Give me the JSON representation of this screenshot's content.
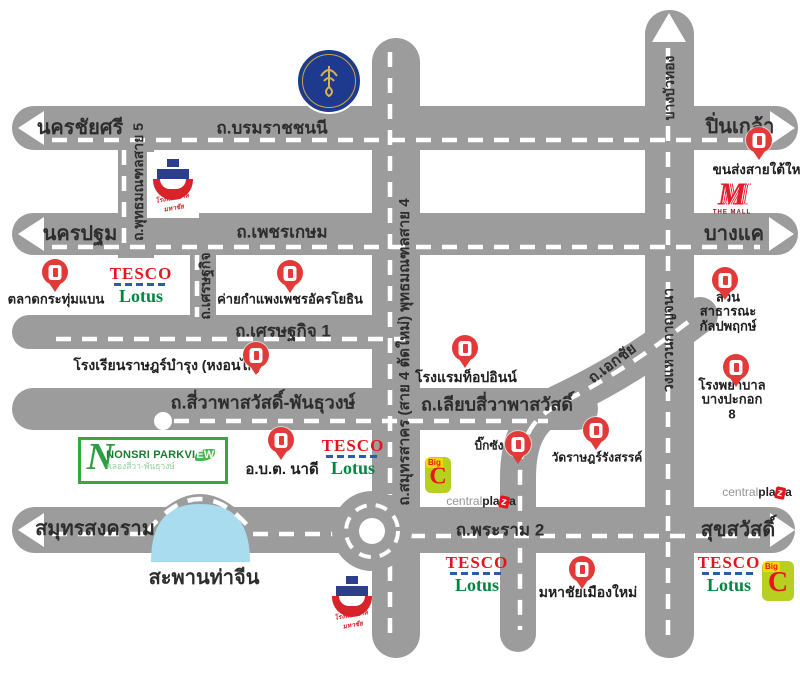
{
  "colors": {
    "road_gray": "#9c9c9c",
    "dash_white": "#ffffff",
    "water_blue": "#a9dcef",
    "pin_red": "#e23a38",
    "tesco_red": "#e8131c",
    "tesco_blue": "#2a5caa",
    "lotus_green": "#008542",
    "bigc_green": "#b8cf22",
    "nonsri_green": "#35a93c",
    "mahidol_navy": "#1d3a8f",
    "hospital_blue": "#2b3f8c",
    "hospital_red": "#d8232a"
  },
  "roads": {
    "boromratchachonnani": "ถ.บรมราชชนนี",
    "phetkasem": "ถ.เพชรเกษม",
    "setthakit1": "ถ.เศรษฐกิจ 1",
    "setthakit_v": "ถ.เศรษฐกิจ",
    "sivapha": "ถ.สี่วาพาสวัสดิ์-พันธุวงษ์",
    "liap_sivapha": "ถ.เลียบสี่วาพาสวัสดิ์",
    "rama2": "ถ.พระราม 2",
    "phutthamonthon5": "ถ.พุทธมณฑลสาย 5",
    "samutsakhon_sai4": "ถ.สมุทรสาคร (สาย 4 ตัดใหม่) พุทธมณฑลสาย 4",
    "ekkachai": "ถ.เอกชัย",
    "kanchanaphisek": "วงแหวนกาญจนา"
  },
  "destinations": {
    "nakhon_chai_si": "นครชัยศรี",
    "pin_klao": "ปิ่นเกล้า",
    "nakhon_pathom": "นครปฐม",
    "bang_khae": "บางแค",
    "samut_songkhram": "สมุทรสงคราม",
    "suk_sawat": "สุขสวัสดิ์",
    "bang_bua_thong": "บางบัวทอง"
  },
  "places": {
    "krathum_baen_market": "ตลาดกระทุ่มแบน",
    "army_camp": "ค่ายกำแพงเพชรอัครโยธิน",
    "school": "โรงเรียนราษฎร์บำรุง (หงอนไก่)",
    "top_inn_hotel": "โรงแรมท็อปอินน์",
    "kalapapruek_park": "สวนสาธารณะ\nกัลปพฤกษ์",
    "bangpakok8_hospital": "โรงพยาบาล\nบางปะกอก 8",
    "southern_bus_terminal": "ขนส่งสายใต้ใหม่",
    "nadi_sao": "อ.บ.ต. นาดี",
    "big_sang": "บิ๊กซัง",
    "wat_rat_rangsan": "วัดราษฎร์รังสรรค์",
    "mahachai_mueang_mai": "มหาชัยเมืองใหม่",
    "tha_chin_bridge": "สะพานท่าจีน"
  },
  "logos": {
    "nonsri": {
      "n": "N",
      "name_prefix": "NONSRI PARKVI",
      "name_leaf": "EW",
      "subtitle": "คลองสี่วา-พันธุวงษ์"
    },
    "tesco": {
      "top": "TESCO",
      "bottom": "Lotus"
    },
    "bigc": {
      "big": "Big",
      "c": "C"
    },
    "centralplaza": {
      "p1": "central",
      "p2": "pla",
      "z": "z",
      "p3": "a"
    },
    "themall": {
      "m": "M",
      "text": "THE MALL"
    },
    "hospital": {
      "caption": "โรงพยาบาลมหาชัย"
    }
  }
}
